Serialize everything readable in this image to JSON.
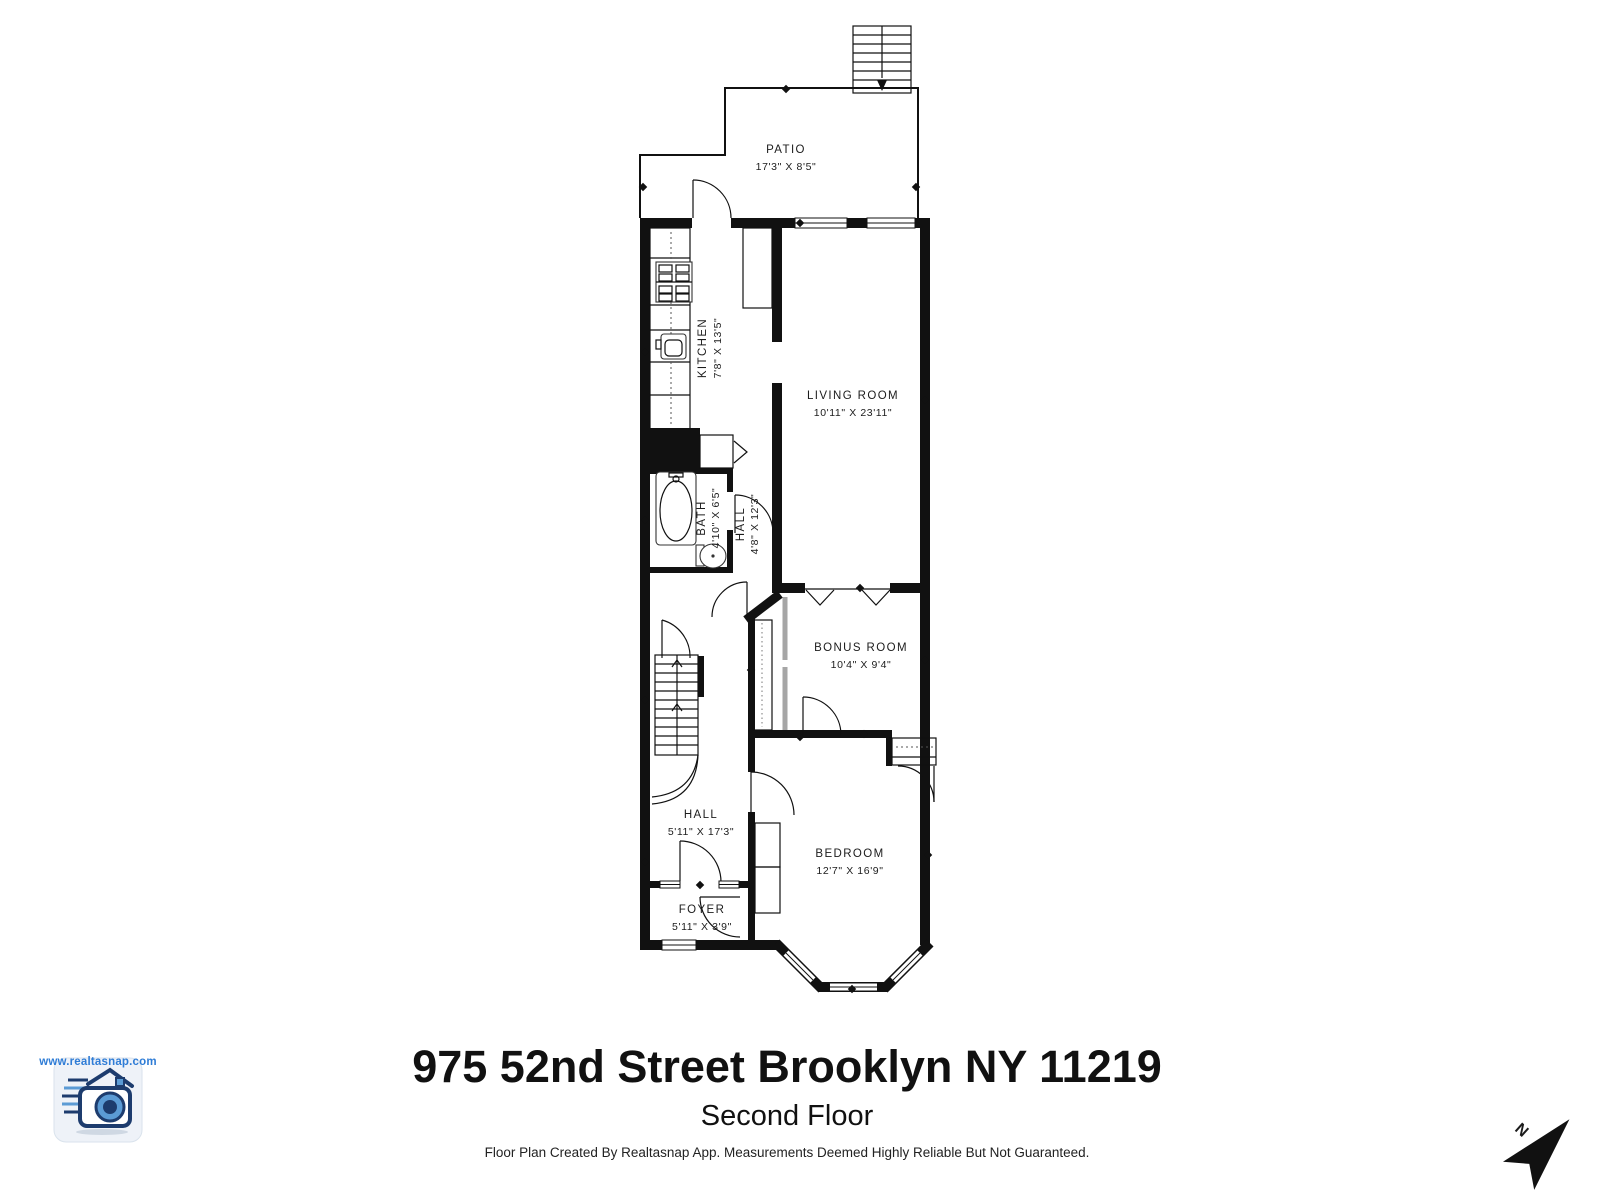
{
  "title_block": {
    "address": "975 52nd Street Brooklyn NY 11219",
    "floor": "Second Floor",
    "disclaimer": "Floor Plan Created By Realtasnap App. Measurements Deemed Highly Reliable But Not Guaranteed."
  },
  "branding": {
    "url": "www.realtasnap.com",
    "logo_icon": "realtasnap-camera-house-logo"
  },
  "compass": {
    "label": "N"
  },
  "rooms": [
    {
      "id": "patio",
      "label": "PATIO",
      "dims": "17'3\" X 8'5\""
    },
    {
      "id": "kitchen",
      "label": "KITCHEN",
      "dims": "7'8\" X 13'5\""
    },
    {
      "id": "living-room",
      "label": "LIVING ROOM",
      "dims": "10'11\" X 23'11\""
    },
    {
      "id": "bath",
      "label": "BATH",
      "dims": "4'10\" X 6'5\""
    },
    {
      "id": "hall-upper",
      "label": "HALL",
      "dims": "4'8\" X 12'3\""
    },
    {
      "id": "bonus-room",
      "label": "BONUS ROOM",
      "dims": "10'4\" X 9'4\""
    },
    {
      "id": "hall-lower",
      "label": "HALL",
      "dims": "5'11\" X 17'3\""
    },
    {
      "id": "foyer",
      "label": "FOYER",
      "dims": "5'11\" X 3'9\""
    },
    {
      "id": "bedroom",
      "label": "BEDROOM",
      "dims": "12'7\" X 16'9\""
    }
  ],
  "colors": {
    "wall": "#111111",
    "background": "#ffffff",
    "brand_blue": "#2e7cd6",
    "slider_gray": "#a6a6a6"
  }
}
